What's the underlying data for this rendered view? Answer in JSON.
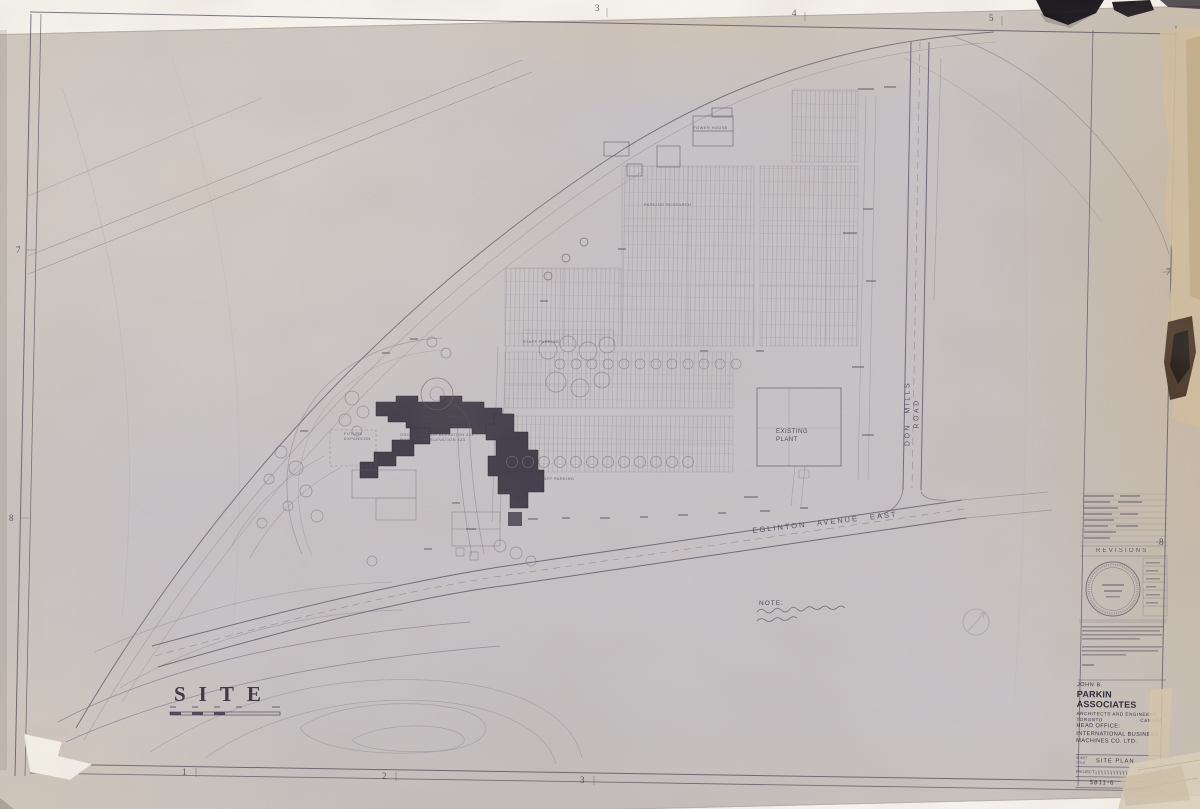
{
  "colors": {
    "paper": "#c8c3c6",
    "ink": "#4d4754",
    "ink_faint": "#8d8794",
    "title_ink": "#332e3b",
    "tape_black": "#17141a",
    "tear_brown": "#4e3c2b"
  },
  "sheet": {
    "drawing_title": "SITE",
    "note_label": "NOTE:",
    "revisions_label": "REVISIONS",
    "grid_refs": {
      "top": [
        "3",
        "4",
        "5"
      ],
      "bottom": [
        "1",
        "2",
        "3"
      ],
      "left": [
        "7",
        "8"
      ],
      "right": [
        "7",
        "8"
      ]
    }
  },
  "plan_labels": {
    "don_mills_road": "DON MILLS ROAD",
    "eglinton_avenue": "EGLINTON AVENUE EAST",
    "existing_plant": "EXISTING\nPLANT",
    "power_house": "POWER HOUSE",
    "staff_parking_upper": "STAFF PARKING",
    "staff_parking_lower": "STAFF PARKING",
    "parking_research": "PARKING RESEARCH",
    "future_expansion": "FUTURE\nEXPANSION",
    "main_entrance": "MAIN ENTRANCE",
    "floor_elevations": "GROUND FLOOR ELEVATION  423\nMAIN FLOOR ELEVATION  433"
  },
  "title_block": {
    "firm_prefix": "JOHN B.",
    "firm_name": "PARKIN ASSOCIATES",
    "firm_subtitle": "ARCHITECTS AND ENGINEERS",
    "firm_city": "TORONTO",
    "firm_country": "CANADA",
    "client_line1": "HEAD OFFICE:",
    "client_line2": "INTERNATIONAL BUSINESS",
    "client_line3": "MACHINES CO. LTD.",
    "sheet_label": "SHEET\nTITLE",
    "sheet_title": "SITE PLAN",
    "project_label": "PROJECT",
    "drawing_number": "5811-6"
  }
}
